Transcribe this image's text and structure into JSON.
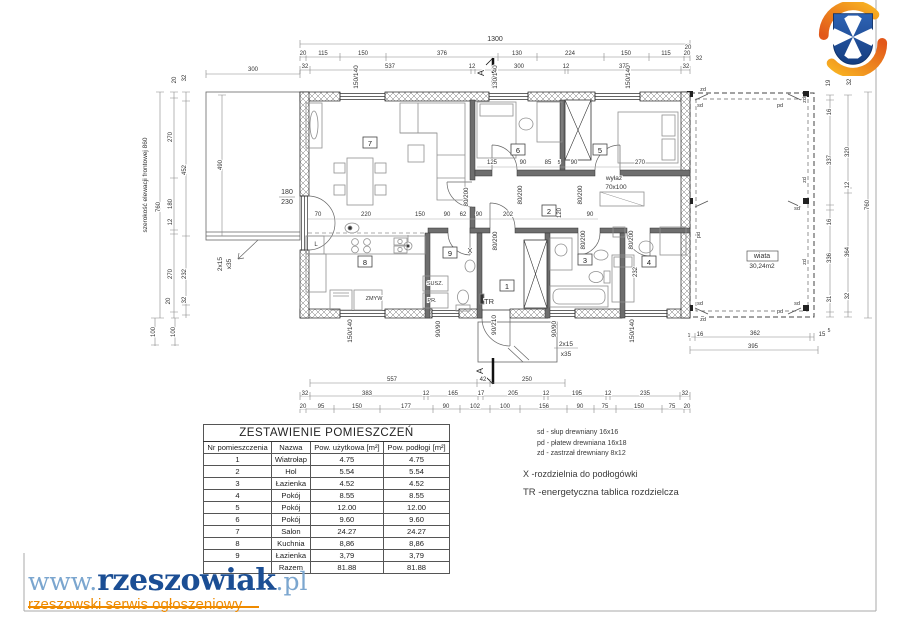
{
  "logo_site": {
    "www": "www.",
    "name": "rzeszowiak",
    "tld": ".pl",
    "tagline": "rzeszowski serwis ogłoszeniowy"
  },
  "crest": {
    "name": "herb-rzeszowa",
    "shield_color": "#2456a4",
    "cross_color": "#ffffff",
    "swirl_color": "#f08a1e"
  },
  "table": {
    "title": "ZESTAWIENIE POMIESZCZEŃ",
    "columns": [
      "Nr pomieszczenia",
      "Nazwa",
      "Pow. użytkowa [m²]",
      "Pow. podłogi [m²]"
    ],
    "rows": [
      [
        "1",
        "Wiatrołap",
        "4.75",
        "4.75"
      ],
      [
        "2",
        "Hol",
        "5.54",
        "5.54"
      ],
      [
        "3",
        "Łazienka",
        "4.52",
        "4.52"
      ],
      [
        "4",
        "Pokój",
        "8.55",
        "8.55"
      ],
      [
        "5",
        "Pokój",
        "12.00",
        "12.00"
      ],
      [
        "6",
        "Pokój",
        "9.60",
        "9.60"
      ],
      [
        "7",
        "Salon",
        "24.27",
        "24.27"
      ],
      [
        "8",
        "Kuchnia",
        "8,86",
        "8,86"
      ],
      [
        "9",
        "Łazienka",
        "3,79",
        "3,79"
      ],
      [
        "",
        "Razem",
        "81.88",
        "81.88"
      ]
    ]
  },
  "legend": {
    "sd": "sd - słup drewniany 16x16",
    "pd": "pd - płatew drewniana 16x18",
    "zd": "zd - zastrzał drewniany 8x12",
    "x": "X -rozdzielnia do podłogówki",
    "tr": "TR -energetyczna tablica rozdzielcza"
  },
  "plan": {
    "rooms": [
      {
        "n": "1",
        "x": 507,
        "y": 288
      },
      {
        "n": "2",
        "x": 549,
        "y": 213
      },
      {
        "n": "3",
        "x": 585,
        "y": 262
      },
      {
        "n": "4",
        "x": 649,
        "y": 264
      },
      {
        "n": "5",
        "x": 600,
        "y": 152
      },
      {
        "n": "6",
        "x": 518,
        "y": 152
      },
      {
        "n": "7",
        "x": 370,
        "y": 145
      },
      {
        "n": "8",
        "x": 365,
        "y": 264
      },
      {
        "n": "9",
        "x": 450,
        "y": 255
      }
    ],
    "labels": [
      {
        "t": "1300",
        "x": 495,
        "y": 41,
        "fs": 7
      },
      {
        "t": "20",
        "x": 303,
        "y": 55
      },
      {
        "t": "115",
        "x": 323,
        "y": 55
      },
      {
        "t": "150",
        "x": 363,
        "y": 55
      },
      {
        "t": "376",
        "x": 442,
        "y": 55
      },
      {
        "t": "130",
        "x": 517,
        "y": 55
      },
      {
        "t": "224",
        "x": 570,
        "y": 55
      },
      {
        "t": "150",
        "x": 626,
        "y": 55
      },
      {
        "t": "115",
        "x": 666,
        "y": 55
      },
      {
        "t": "20",
        "x": 687,
        "y": 55
      },
      {
        "t": "32",
        "x": 305,
        "y": 68
      },
      {
        "t": "537",
        "x": 390,
        "y": 68
      },
      {
        "t": "12",
        "x": 472,
        "y": 68
      },
      {
        "t": "300",
        "x": 519,
        "y": 68
      },
      {
        "t": "12",
        "x": 566,
        "y": 68
      },
      {
        "t": "375",
        "x": 624,
        "y": 68
      },
      {
        "t": "32",
        "x": 686,
        "y": 68
      },
      {
        "t": "300",
        "x": 253,
        "y": 71
      },
      {
        "t": "20",
        "x": 176,
        "y": 80,
        "r": -90
      },
      {
        "t": "32",
        "x": 186,
        "y": 78,
        "r": -90
      },
      {
        "t": "20",
        "x": 688,
        "y": 49
      },
      {
        "t": "32",
        "x": 699,
        "y": 60
      },
      {
        "t": "19",
        "x": 830,
        "y": 83,
        "r": -90
      },
      {
        "t": "32",
        "x": 851,
        "y": 82,
        "r": -90
      },
      {
        "t": "150/140",
        "x": 358,
        "y": 77,
        "r": -90,
        "fs": 6.5
      },
      {
        "t": "130/140",
        "x": 497,
        "y": 77,
        "r": -90,
        "fs": 6.5
      },
      {
        "t": "150/140",
        "x": 630,
        "y": 77,
        "r": -90,
        "fs": 6.5
      },
      {
        "t": "150/140",
        "x": 352,
        "y": 331,
        "r": -90,
        "fs": 6.5
      },
      {
        "t": "90/90",
        "x": 440,
        "y": 329,
        "r": -90,
        "fs": 6.5
      },
      {
        "t": "90/90",
        "x": 556,
        "y": 329,
        "r": -90,
        "fs": 6.5
      },
      {
        "t": "150/140",
        "x": 634,
        "y": 331,
        "r": -90,
        "fs": 6.5
      },
      {
        "t": "90/210",
        "x": 496,
        "y": 325,
        "r": -90,
        "fs": 6.5
      },
      {
        "t": "180",
        "x": 287,
        "y": 194,
        "fs": 7
      },
      {
        "t": "230",
        "x": 287,
        "y": 204,
        "fs": 7
      },
      {
        "t": "2x15",
        "x": 222,
        "y": 264,
        "r": -90,
        "fs": 6.5
      },
      {
        "t": "x35",
        "x": 231,
        "y": 264,
        "r": -90,
        "fs": 6.5
      },
      {
        "t": "2x15",
        "x": 566,
        "y": 346,
        "fs": 6.5
      },
      {
        "t": "x35",
        "x": 566,
        "y": 356,
        "fs": 6.5
      },
      {
        "t": "szerokość elewacji frontowej  860",
        "x": 147,
        "y": 185,
        "r": -90,
        "fs": 6.5
      },
      {
        "t": "760",
        "x": 160,
        "y": 207,
        "r": -90
      },
      {
        "t": "270",
        "x": 172,
        "y": 137,
        "r": -90
      },
      {
        "t": "180",
        "x": 172,
        "y": 204,
        "r": -90
      },
      {
        "t": "12",
        "x": 172,
        "y": 222,
        "r": -90
      },
      {
        "t": "270",
        "x": 172,
        "y": 274,
        "r": -90
      },
      {
        "t": "20",
        "x": 170,
        "y": 301,
        "r": -90
      },
      {
        "t": "32",
        "x": 186,
        "y": 300,
        "r": -90
      },
      {
        "t": "452",
        "x": 186,
        "y": 170,
        "r": -90
      },
      {
        "t": "232",
        "x": 186,
        "y": 274,
        "r": -90
      },
      {
        "t": "100",
        "x": 155,
        "y": 332,
        "r": -90
      },
      {
        "t": "100",
        "x": 175,
        "y": 332,
        "r": -90
      },
      {
        "t": "490",
        "x": 222,
        "y": 165,
        "r": -90
      },
      {
        "t": "16",
        "x": 831,
        "y": 112,
        "r": -90
      },
      {
        "t": "337",
        "x": 831,
        "y": 160,
        "r": -90
      },
      {
        "t": "16",
        "x": 831,
        "y": 222,
        "r": -90
      },
      {
        "t": "336",
        "x": 831,
        "y": 258,
        "r": -90
      },
      {
        "t": "31",
        "x": 831,
        "y": 299,
        "r": -90
      },
      {
        "t": "320",
        "x": 849,
        "y": 152,
        "r": -90
      },
      {
        "t": "12",
        "x": 849,
        "y": 185,
        "r": -90
      },
      {
        "t": "364",
        "x": 849,
        "y": 252,
        "r": -90
      },
      {
        "t": "32",
        "x": 849,
        "y": 296,
        "r": -90
      },
      {
        "t": "760",
        "x": 869,
        "y": 205,
        "r": -90
      },
      {
        "t": "1",
        "x": 689,
        "y": 337,
        "fs": 5
      },
      {
        "t": "16",
        "x": 700,
        "y": 336
      },
      {
        "t": "362",
        "x": 755,
        "y": 335
      },
      {
        "t": "15",
        "x": 822,
        "y": 336
      },
      {
        "t": "5",
        "x": 829,
        "y": 332,
        "fs": 5
      },
      {
        "t": "395",
        "x": 753,
        "y": 348
      },
      {
        "t": "557",
        "x": 392,
        "y": 381
      },
      {
        "t": "42",
        "x": 483,
        "y": 381
      },
      {
        "t": "250",
        "x": 527,
        "y": 381
      },
      {
        "t": "32",
        "x": 305,
        "y": 395
      },
      {
        "t": "383",
        "x": 367,
        "y": 395
      },
      {
        "t": "12",
        "x": 426,
        "y": 395
      },
      {
        "t": "165",
        "x": 453,
        "y": 395
      },
      {
        "t": "17",
        "x": 481,
        "y": 395
      },
      {
        "t": "205",
        "x": 513,
        "y": 395
      },
      {
        "t": "12",
        "x": 546,
        "y": 395
      },
      {
        "t": "195",
        "x": 577,
        "y": 395
      },
      {
        "t": "12",
        "x": 608,
        "y": 395
      },
      {
        "t": "235",
        "x": 645,
        "y": 395
      },
      {
        "t": "32",
        "x": 685,
        "y": 395
      },
      {
        "t": "20",
        "x": 303,
        "y": 408
      },
      {
        "t": "95",
        "x": 321,
        "y": 408
      },
      {
        "t": "150",
        "x": 357,
        "y": 408
      },
      {
        "t": "177",
        "x": 406,
        "y": 408
      },
      {
        "t": "90",
        "x": 446,
        "y": 408
      },
      {
        "t": "102",
        "x": 475,
        "y": 408
      },
      {
        "t": "100",
        "x": 505,
        "y": 408
      },
      {
        "t": "156",
        "x": 544,
        "y": 408
      },
      {
        "t": "90",
        "x": 580,
        "y": 408
      },
      {
        "t": "75",
        "x": 605,
        "y": 408
      },
      {
        "t": "150",
        "x": 639,
        "y": 408
      },
      {
        "t": "75",
        "x": 672,
        "y": 408
      },
      {
        "t": "20",
        "x": 687,
        "y": 408
      },
      {
        "t": "70",
        "x": 318,
        "y": 216
      },
      {
        "t": "220",
        "x": 366,
        "y": 216
      },
      {
        "t": "150",
        "x": 420,
        "y": 216
      },
      {
        "t": "90",
        "x": 447,
        "y": 216
      },
      {
        "t": "62",
        "x": 463,
        "y": 216
      },
      {
        "t": "90",
        "x": 479,
        "y": 216
      },
      {
        "t": "202",
        "x": 508,
        "y": 216
      },
      {
        "t": "120",
        "x": 561,
        "y": 213,
        "r": -90
      },
      {
        "t": "90",
        "x": 590,
        "y": 216
      },
      {
        "t": "125",
        "x": 492,
        "y": 164
      },
      {
        "t": "90",
        "x": 523,
        "y": 164
      },
      {
        "t": "85",
        "x": 548,
        "y": 164
      },
      {
        "t": "5",
        "x": 559,
        "y": 164,
        "fs": 5
      },
      {
        "t": "90",
        "x": 574,
        "y": 164
      },
      {
        "t": "270",
        "x": 640,
        "y": 164
      },
      {
        "t": "232",
        "x": 637,
        "y": 272,
        "r": -90
      },
      {
        "t": "80/200",
        "x": 468,
        "y": 197,
        "r": -90,
        "fs": 6.2
      },
      {
        "t": "80/200",
        "x": 522,
        "y": 195,
        "r": -90,
        "fs": 6.2
      },
      {
        "t": "80/200",
        "x": 582,
        "y": 195,
        "r": -90,
        "fs": 6.2
      },
      {
        "t": "80/200",
        "x": 497,
        "y": 241,
        "r": -90,
        "fs": 6.2
      },
      {
        "t": "80/200",
        "x": 585,
        "y": 240,
        "r": -90,
        "fs": 6.2
      },
      {
        "t": "80/200",
        "x": 633,
        "y": 240,
        "r": -90,
        "fs": 6.2
      },
      {
        "t": "wyłaz",
        "x": 614,
        "y": 180,
        "fs": 6.5
      },
      {
        "t": "70x100",
        "x": 616,
        "y": 189,
        "fs": 6.5
      },
      {
        "t": "L",
        "x": 316,
        "y": 246
      },
      {
        "t": "ZMYW",
        "x": 374,
        "y": 300,
        "fs": 5.5
      },
      {
        "t": "SUSZ.",
        "x": 435,
        "y": 285,
        "fs": 5.5
      },
      {
        "t": "PR.",
        "x": 432,
        "y": 302,
        "fs": 5.5
      },
      {
        "t": "X",
        "x": 470,
        "y": 253,
        "fs": 7
      },
      {
        "t": "TR",
        "x": 489,
        "y": 304,
        "fs": 7.5
      },
      {
        "t": "wiata",
        "x": 762,
        "y": 258,
        "fs": 7
      },
      {
        "t": "30,24m2",
        "x": 762,
        "y": 268,
        "fs": 6.5
      },
      {
        "t": "zd",
        "x": 703,
        "y": 91,
        "fs": 5.5
      },
      {
        "t": "sd",
        "x": 700,
        "y": 107,
        "fs": 5.5
      },
      {
        "t": "pd",
        "x": 780,
        "y": 107,
        "fs": 5.5
      },
      {
        "t": "zd",
        "x": 806,
        "y": 100,
        "r": -90,
        "fs": 5.5
      },
      {
        "t": "pd",
        "x": 700,
        "y": 235,
        "r": -90,
        "fs": 5.5
      },
      {
        "t": "zd",
        "x": 806,
        "y": 180,
        "r": -90,
        "fs": 5.5
      },
      {
        "t": "sd",
        "x": 797,
        "y": 210,
        "fs": 5.5
      },
      {
        "t": "zd",
        "x": 806,
        "y": 262,
        "r": -90,
        "fs": 5.5
      },
      {
        "t": "sd",
        "x": 700,
        "y": 305,
        "fs": 5.5
      },
      {
        "t": "pd",
        "x": 780,
        "y": 313,
        "fs": 5.5
      },
      {
        "t": "zd",
        "x": 703,
        "y": 321,
        "fs": 5.5
      },
      {
        "t": "sd",
        "x": 797,
        "y": 305,
        "fs": 5.5
      },
      {
        "t": "A",
        "x": 484,
        "y": 73,
        "r": -90,
        "fs": 9
      },
      {
        "t": "A",
        "x": 483,
        "y": 371,
        "r": -90,
        "fs": 9
      }
    ]
  }
}
